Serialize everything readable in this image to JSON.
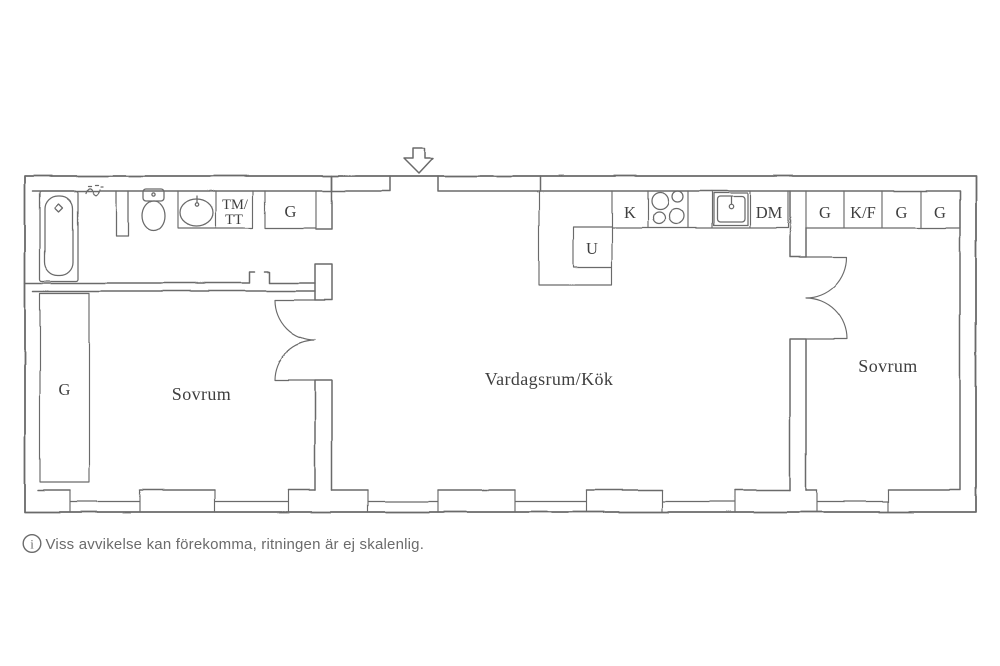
{
  "colors": {
    "background": "#ffffff",
    "line": "#6a6a6a",
    "label": "#3f3f3f",
    "caption": "#6b6b6b"
  },
  "plan": {
    "rooms": {
      "bedroom_left": "Sovrum",
      "living_kitchen": "Vardagsrum/Kök",
      "bedroom_right": "Sovrum"
    },
    "labels": {
      "washer_line1": "TM/",
      "washer_line2": "TT",
      "hall_wardrobe": "G",
      "bedroom_left_wardrobe": "G",
      "oven": "U",
      "fridge": "K",
      "dishwasher": "DM",
      "wardrobe_1": "G",
      "fridge_freezer": "K/F",
      "wardrobe_2": "G",
      "wardrobe_3": "G"
    }
  },
  "caption": {
    "symbol": "i",
    "text": "Viss avvikelse kan förekomma, ritningen är ej skalenlig."
  }
}
